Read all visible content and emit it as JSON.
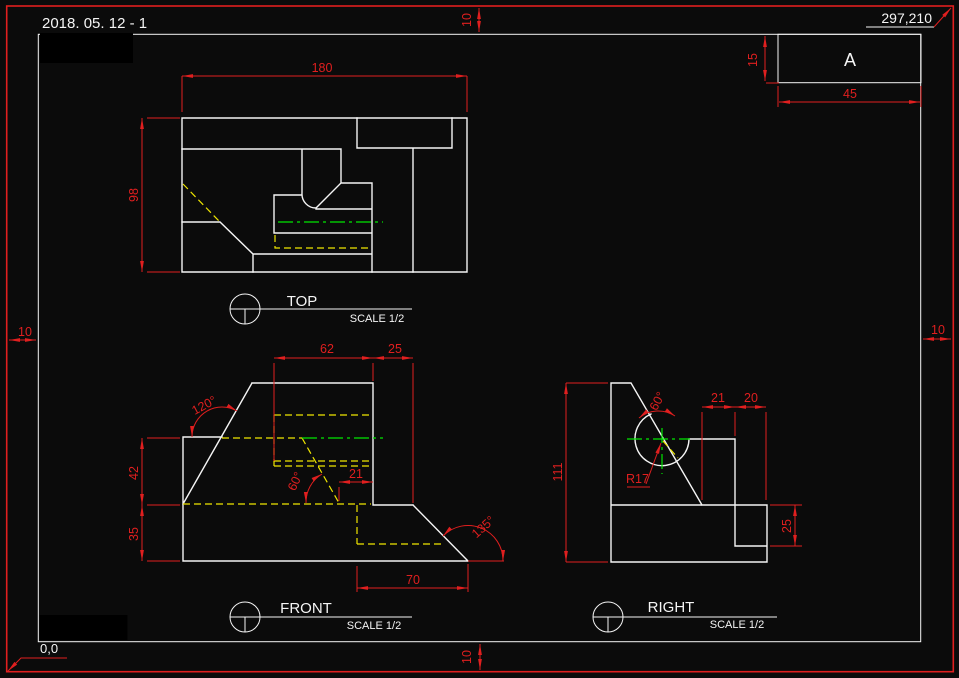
{
  "colors": {
    "background": "#0b0b0b",
    "geometry_white": "#f5f5f5",
    "dimension_red": "#e01f1f",
    "hidden_line_yellow": "#efe600",
    "center_line_green": "#00e500"
  },
  "header": {
    "date_title": "2018. 05. 12 - 1",
    "sheet_extents": "297,210",
    "origin_label": "0,0",
    "zone_label": "A"
  },
  "margins": {
    "top": "10",
    "bottom": "10",
    "left": "10",
    "right": "10"
  },
  "title_block": {
    "height_dim": "15",
    "width_dim": "45"
  },
  "views": {
    "top": {
      "label": "TOP",
      "scale_note": "SCALE 1/2",
      "dims": {
        "width": "180",
        "depth": "98"
      }
    },
    "front": {
      "label": "FRONT",
      "scale_note": "SCALE 1/2",
      "dims": {
        "slot_width": "62",
        "step_width": "25",
        "mid_height": "42",
        "base_height": "35",
        "offset": "21",
        "base_width": "70"
      },
      "angles": {
        "left_slope": "120°",
        "slot": "60°",
        "right_slope": "135°"
      }
    },
    "right": {
      "label": "RIGHT",
      "scale_note": "SCALE 1/2",
      "dims": {
        "height": "111",
        "step_a": "21",
        "step_b": "20",
        "notch": "25"
      },
      "radius_label": "R17",
      "angle": "60°"
    }
  }
}
